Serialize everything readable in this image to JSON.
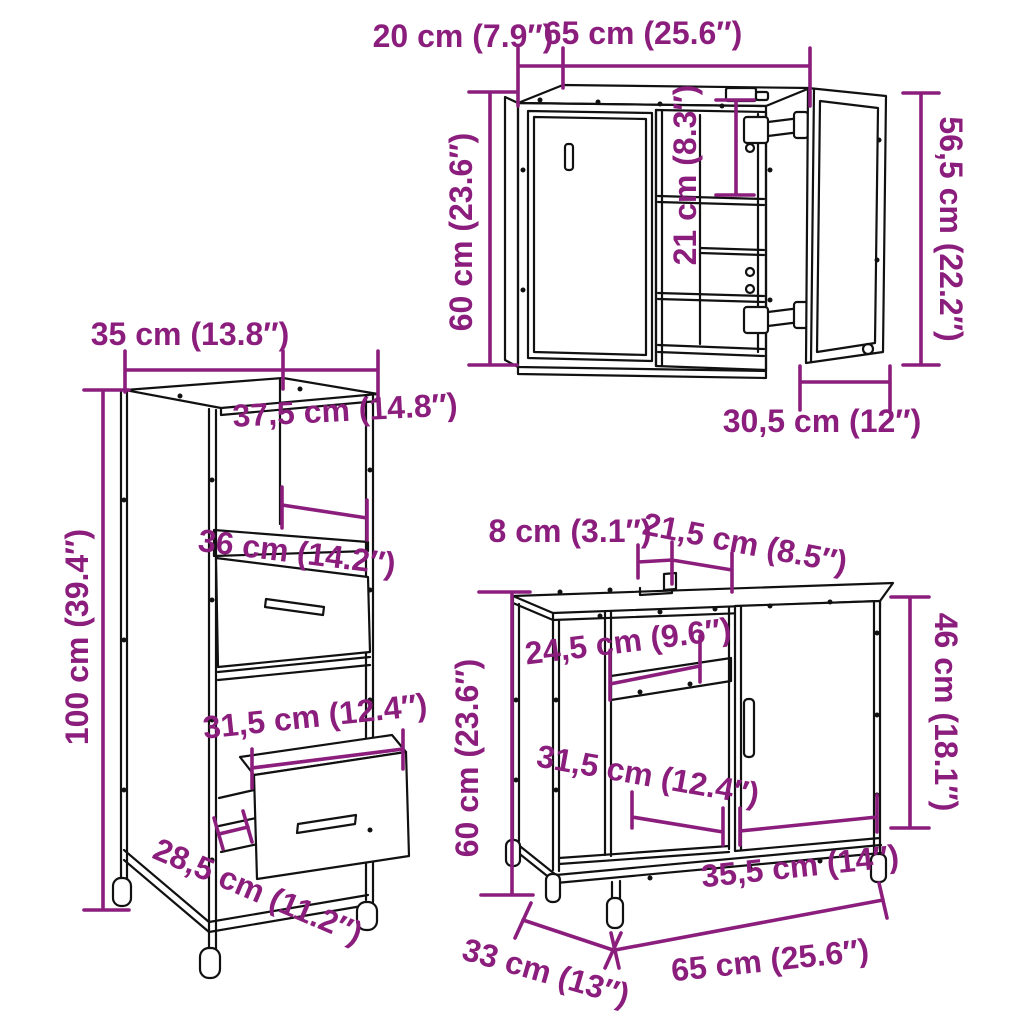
{
  "colors": {
    "dimension_annotation": "#8B1E7D",
    "line_art": "#111111",
    "background": "#FFFFFF"
  },
  "wall_cabinet": {
    "depth": "20 cm (7.9″)",
    "width": "65 cm (25.6″)",
    "height": "60 cm (23.6″)",
    "inner_height": "21 cm (8.3″)",
    "door_height": "56,5 cm (22.2″)",
    "door_width": "30,5 cm (12″)"
  },
  "tall_cabinet": {
    "depth": "35 cm (13.8″)",
    "width": "37,5 cm (14.8″)",
    "shelf_width": "36 cm (14.2″)",
    "height": "100 cm (39.4″)",
    "drawer_width": "31,5 cm (12.4″)",
    "drawer_depth": "28,5 cm (11.2″)"
  },
  "sink_cabinet": {
    "notch_width": "8 cm (3.1″)",
    "notch_offset": "21,5 cm (8.5″)",
    "shelf_width": "24,5 cm (9.6″)",
    "height": "60 cm (23.6″)",
    "door_height": "46 cm (18.1″)",
    "compartment_width": "31,5 cm (12.4″)",
    "base_width": "35,5 cm (14″)",
    "depth": "33 cm (13″)",
    "width": "65 cm (25.6″)"
  }
}
